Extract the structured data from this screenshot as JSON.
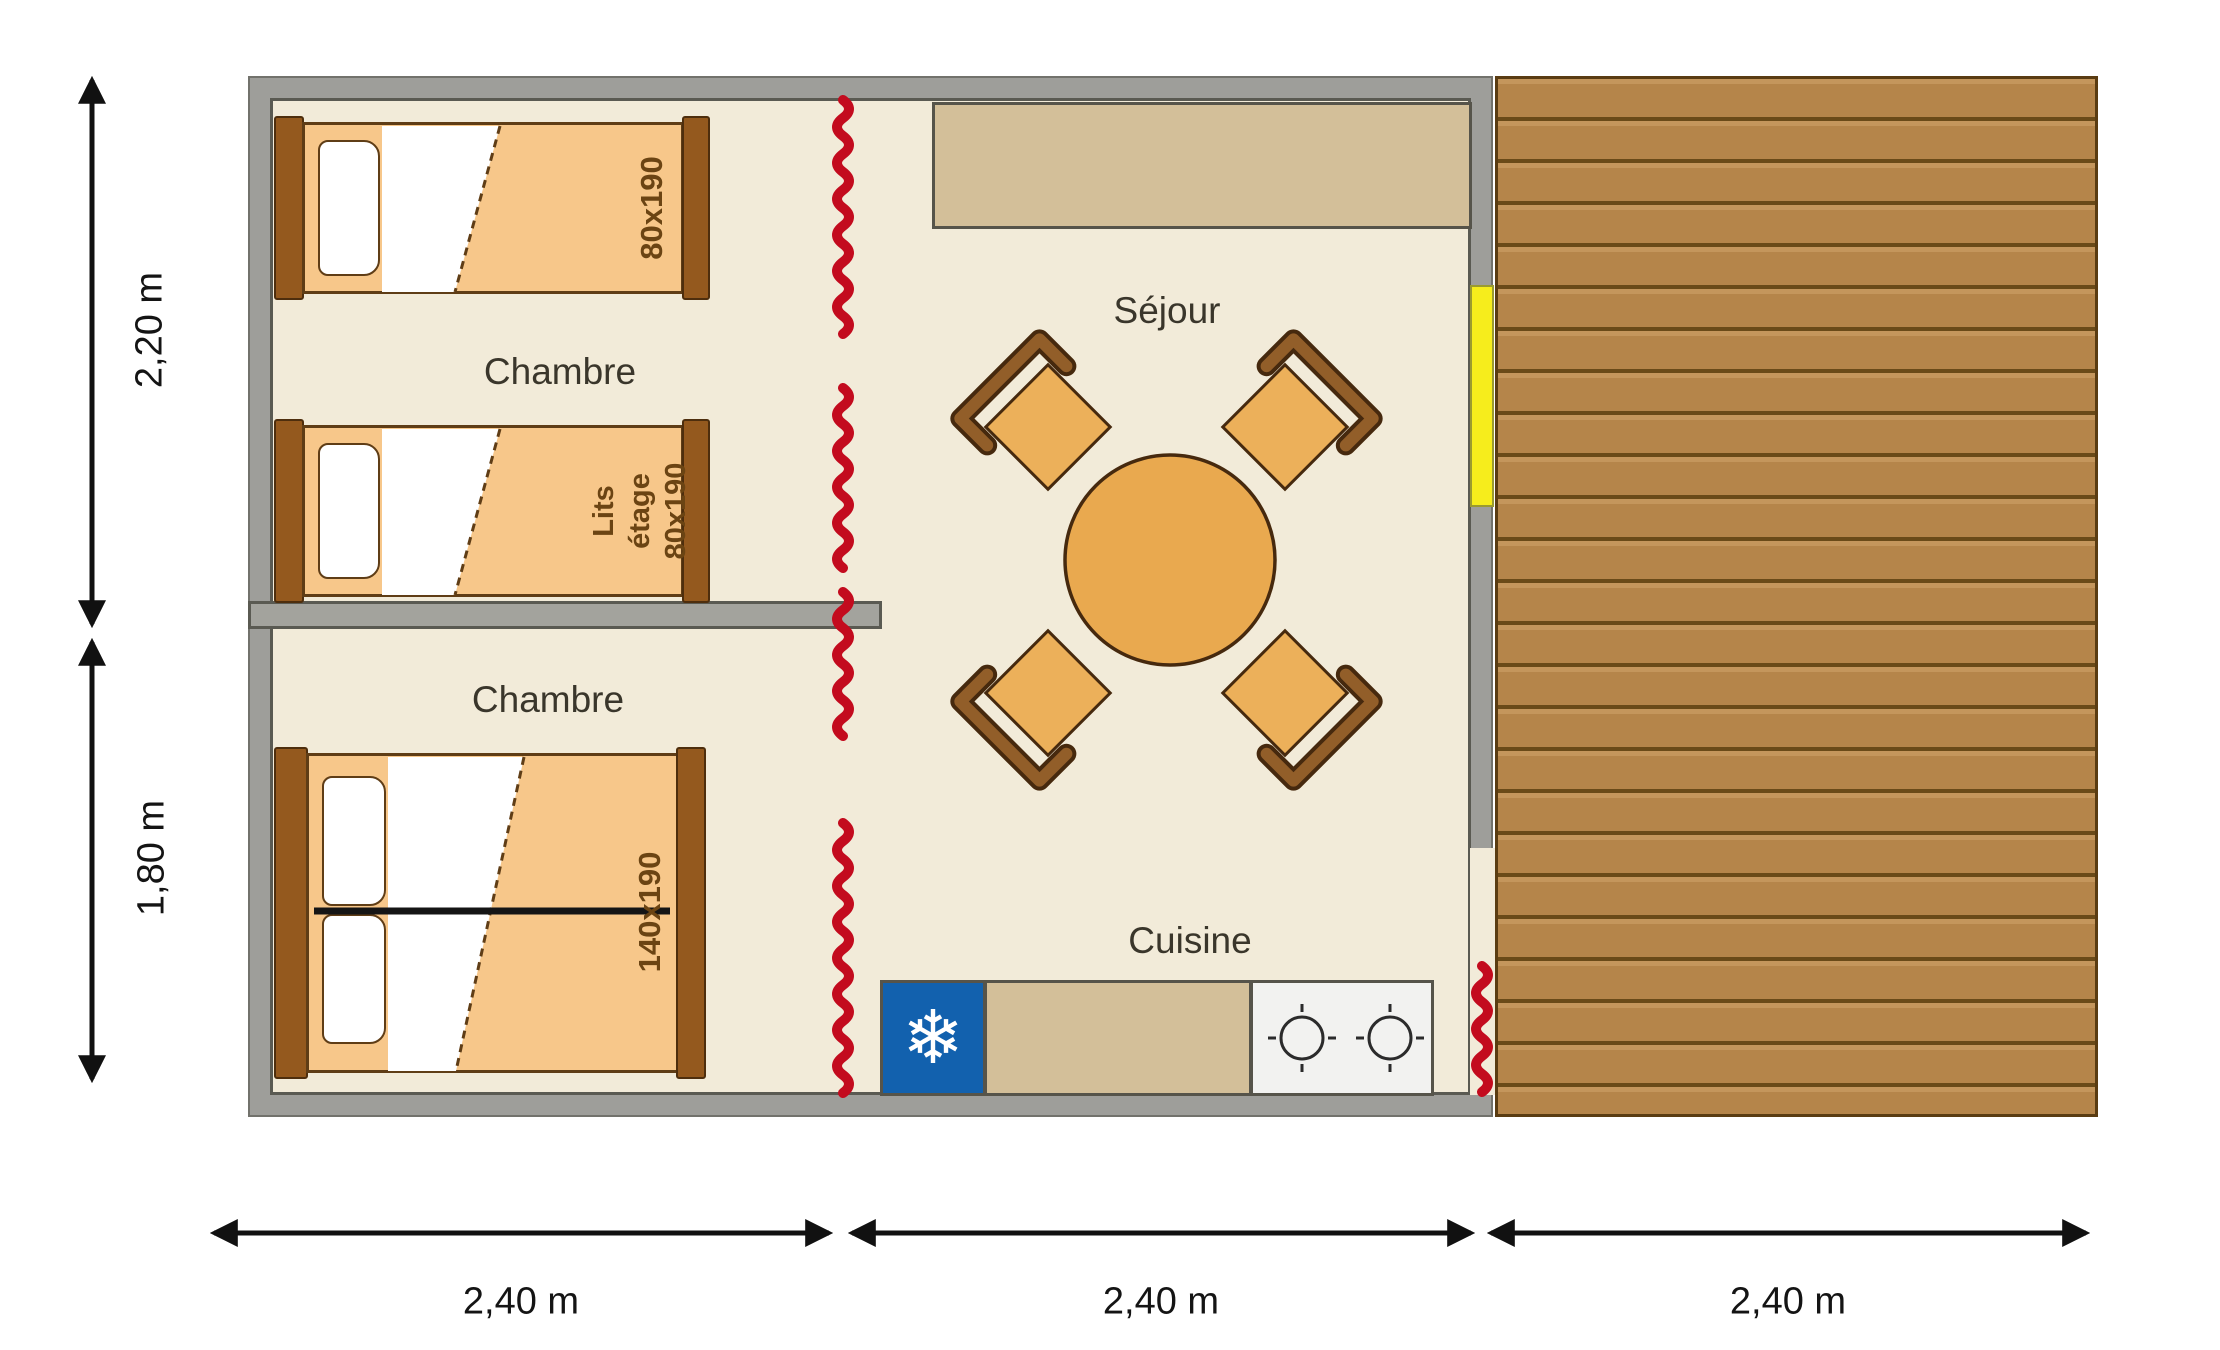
{
  "plan": {
    "rooms": {
      "bedroom_top": {
        "label": "Chambre"
      },
      "bedroom_bottom": {
        "label": "Chambre"
      },
      "living_room": {
        "label": "Séjour"
      },
      "kitchen": {
        "label": "Cuisine"
      }
    },
    "beds": {
      "single_top": {
        "size": "80x190"
      },
      "bunk": {
        "line1": "Lits",
        "line2": "étage",
        "line3": "80x190"
      },
      "double": {
        "size": "140x190"
      }
    },
    "dimensions": {
      "side_top": "2,20 m",
      "side_bottom": "1,80 m",
      "bottom_left": "2,40 m",
      "bottom_center": "2,40 m",
      "bottom_right": "2,40 m"
    },
    "icons": {
      "fridge_glyph": "❄"
    },
    "colors": {
      "wall_gray": "#9e9e9a",
      "floor_beige": "#f2ebd9",
      "bed_orange": "#f7c78a",
      "wood_brown": "#94591e",
      "deck_brown": "#b5854a",
      "curtain_red": "#c30b1e",
      "door_yellow": "#f6ed1c",
      "fridge_blue": "#1261ae",
      "table_orange": "#e9a94f",
      "counter_tan": "#d3bf99"
    }
  }
}
